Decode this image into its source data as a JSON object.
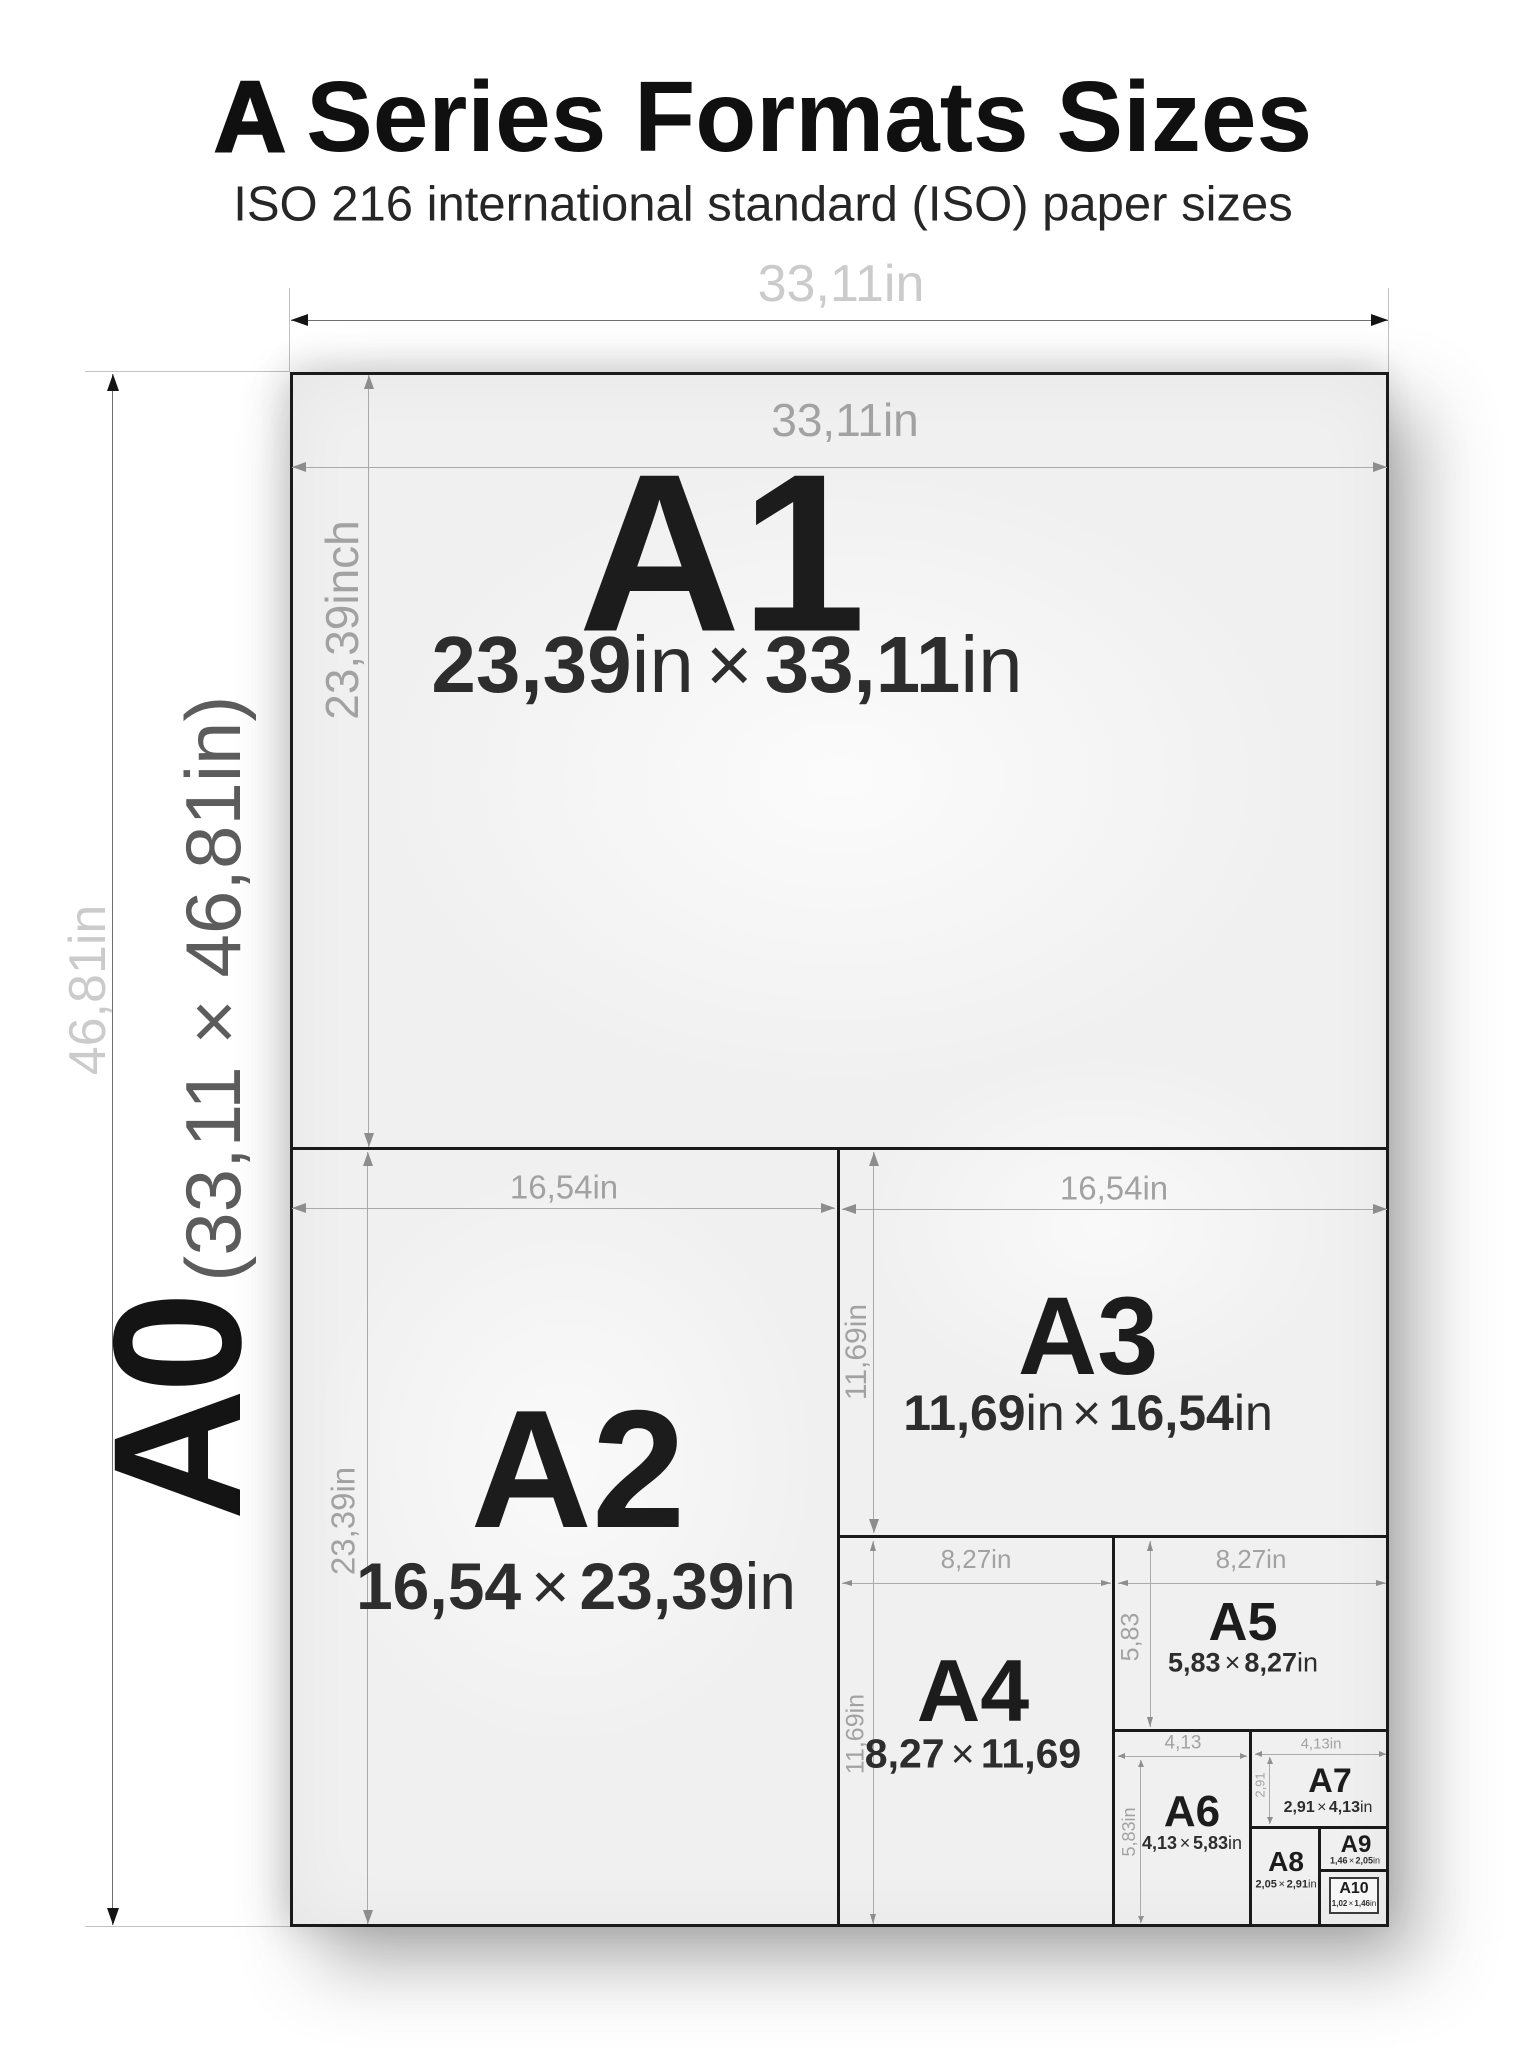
{
  "title": {
    "lead": "A",
    "rest": "Series Formats Sizes"
  },
  "subtitle": "ISO 216 international standard (ISO) paper sizes",
  "ui": {
    "times": "×"
  },
  "outer_dims": {
    "width_label": "33,11in",
    "height_label": "46,81in"
  },
  "a0": {
    "name": "A0",
    "dims": "(33,11 × 46,81in)"
  },
  "papers": {
    "a1": {
      "name": "A1",
      "w": "23,39",
      "wu": "in",
      "h": "33,11",
      "hu": "in",
      "top_label": "33,11in",
      "side_label": "23,39inch"
    },
    "a2": {
      "name": "A2",
      "w": "16,54",
      "wu": "",
      "h": "23,39",
      "hu": "in",
      "top_label": "16,54in",
      "side_label": "23,39in"
    },
    "a3": {
      "name": "A3",
      "w": "11,69",
      "wu": "in",
      "h": "16,54",
      "hu": "in",
      "top_label": "16,54in",
      "side_label": "11,69in"
    },
    "a4": {
      "name": "A4",
      "w": "8,27",
      "wu": "",
      "h": "11,69",
      "hu": "",
      "top_label": "8,27in",
      "side_label": "11,69in"
    },
    "a5": {
      "name": "A5",
      "w": "5,83",
      "wu": "",
      "h": "8,27",
      "hu": "in",
      "top_label": "8,27in",
      "side_label": "5,83"
    },
    "a6": {
      "name": "A6",
      "w": "4,13",
      "wu": "",
      "h": "5,83",
      "hu": "in",
      "top_label": "4,13",
      "side_label": "5,83in"
    },
    "a7": {
      "name": "A7",
      "w": "2,91",
      "wu": "",
      "h": "4,13",
      "hu": "in",
      "top_label": "4,13in",
      "side_label": "2,91"
    },
    "a8": {
      "name": "A8",
      "w": "2,05",
      "wu": "",
      "h": "2,91",
      "hu": "in"
    },
    "a9": {
      "name": "A9",
      "w": "1,46",
      "wu": "",
      "h": "2,05",
      "hu": "in"
    },
    "a10": {
      "name": "A10",
      "w": "1,02",
      "wu": "",
      "h": "1,46",
      "hu": "in"
    }
  },
  "colors": {
    "ink": "#1a1a1a",
    "paper_fill": "#f0f0f0",
    "dim_line": "#a9a9a9",
    "dim_label": "#a2a2a2",
    "outer_label": "#cbcbcb",
    "background": "#ffffff"
  }
}
